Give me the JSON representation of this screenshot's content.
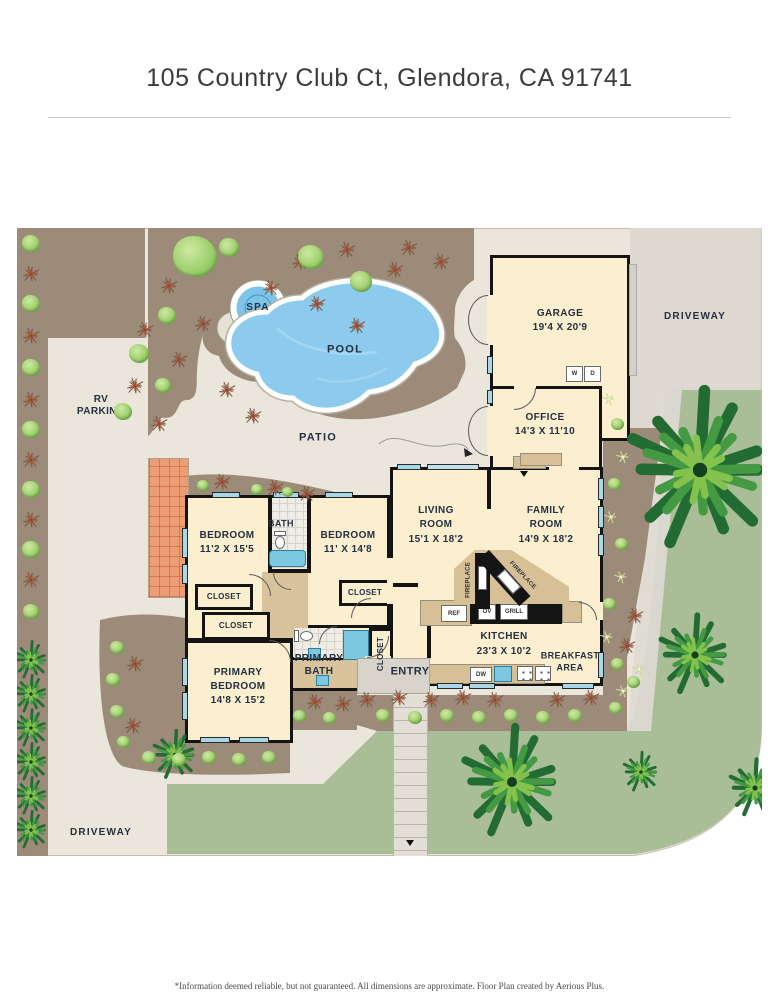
{
  "header": {
    "title": "105 Country Club Ct, Glendora, CA 91741"
  },
  "footer": {
    "disclaimer": "*Information deemed reliable, but not guaranteed. All dimensions are approximate. Floor Plan created by Aerious Plus."
  },
  "rooms": {
    "garage": {
      "name": "GARAGE",
      "dims": "19'4 X 20'9"
    },
    "office": {
      "name": "OFFICE",
      "dims": "14'3 X 11'10"
    },
    "living": {
      "l1": "LIVING",
      "l2": "ROOM",
      "dims": "15'1 X 18'2"
    },
    "family": {
      "l1": "FAMILY",
      "l2": "ROOM",
      "dims": "14'9 X 18'2"
    },
    "kitchen": {
      "name": "KITCHEN",
      "dims": "23'3 X 10'2"
    },
    "breakfast": {
      "l1": "BREAKFAST",
      "l2": "AREA"
    },
    "bedroom1": {
      "name": "BEDROOM",
      "dims": "11'2 X 15'5"
    },
    "bedroom2": {
      "name": "BEDROOM",
      "dims": "11' X 14'8"
    },
    "primary_bedroom": {
      "l1": "PRIMARY",
      "l2": "BEDROOM",
      "dims": "14'8 X 15'2"
    },
    "primary_bath": {
      "l1": "PRIMARY",
      "l2": "BATH"
    },
    "bath": {
      "name": "BATH"
    },
    "entry": {
      "name": "ENTRY"
    },
    "closet": "CLOSET"
  },
  "outdoor": {
    "pool": "POOL",
    "spa": "SPA",
    "patio": "PATIO",
    "rv_l1": "RV",
    "rv_l2": "PARKING",
    "driveway_right": "DRIVEWAY",
    "driveway_bottom": "DRIVEWAY"
  },
  "fixtures": {
    "washer": "W",
    "dryer": "D",
    "fridge": "REF",
    "oven": "OV",
    "grill": "GRILL",
    "dishwasher": "DW",
    "fireplace": "FIREPLACE"
  },
  "colors": {
    "site": "#eae6db",
    "planting_bed": "#9c8b78",
    "lawn": "#a9bd97",
    "driveway": "#ddd8d0",
    "room_fill": "#fbefcf",
    "wall": "#141414",
    "pool_water": "#8ccaee",
    "window": "#a8d8e7",
    "tile_patio": "#ec9d74",
    "counter": "#d8c096",
    "label_text": "#243040"
  },
  "plants": {
    "bushes": [
      [
        178,
        30,
        44
      ],
      [
        150,
        88,
        18
      ],
      [
        122,
        126,
        20
      ],
      [
        146,
        158,
        16
      ],
      [
        106,
        184,
        18
      ],
      [
        294,
        30,
        26
      ],
      [
        344,
        54,
        22
      ],
      [
        212,
        20,
        20
      ],
      [
        14,
        16,
        18
      ],
      [
        14,
        76,
        18
      ],
      [
        14,
        140,
        18
      ],
      [
        14,
        202,
        18
      ],
      [
        14,
        262,
        18
      ],
      [
        14,
        322,
        18
      ],
      [
        14,
        384,
        16
      ],
      [
        600,
        196,
        13
      ],
      [
        597,
        256,
        13
      ],
      [
        604,
        316,
        13
      ],
      [
        592,
        376,
        13
      ],
      [
        600,
        436,
        13
      ],
      [
        366,
        488,
        14
      ],
      [
        398,
        490,
        14
      ],
      [
        430,
        488,
        14
      ],
      [
        462,
        490,
        14
      ],
      [
        494,
        488,
        14
      ],
      [
        526,
        490,
        14
      ],
      [
        558,
        488,
        14
      ],
      [
        598,
        480,
        13
      ],
      [
        616,
        454,
        13
      ],
      [
        100,
        420,
        14
      ],
      [
        96,
        452,
        14
      ],
      [
        100,
        484,
        14
      ],
      [
        106,
        514,
        13
      ],
      [
        132,
        530,
        14
      ],
      [
        162,
        532,
        14
      ],
      [
        192,
        530,
        14
      ],
      [
        222,
        532,
        14
      ],
      [
        252,
        530,
        14
      ],
      [
        282,
        488,
        13
      ],
      [
        312,
        490,
        13
      ],
      [
        186,
        258,
        12
      ],
      [
        240,
        262,
        12
      ],
      [
        270,
        264,
        11
      ]
    ],
    "spiky": [
      [
        152,
        58
      ],
      [
        186,
        96
      ],
      [
        128,
        102
      ],
      [
        162,
        132
      ],
      [
        118,
        158
      ],
      [
        142,
        196
      ],
      [
        254,
        60
      ],
      [
        283,
        34
      ],
      [
        330,
        22
      ],
      [
        378,
        42
      ],
      [
        300,
        76
      ],
      [
        340,
        98
      ],
      [
        210,
        162
      ],
      [
        236,
        188
      ],
      [
        392,
        20
      ],
      [
        424,
        34
      ],
      [
        14,
        46
      ],
      [
        14,
        108
      ],
      [
        14,
        172
      ],
      [
        14,
        232
      ],
      [
        14,
        292
      ],
      [
        14,
        352
      ],
      [
        350,
        472
      ],
      [
        382,
        470
      ],
      [
        414,
        472
      ],
      [
        446,
        470
      ],
      [
        478,
        472
      ],
      [
        540,
        472
      ],
      [
        574,
        470
      ],
      [
        610,
        418
      ],
      [
        618,
        388
      ],
      [
        118,
        436
      ],
      [
        116,
        498
      ],
      [
        298,
        474
      ],
      [
        326,
        476
      ],
      [
        205,
        254
      ],
      [
        258,
        260
      ],
      [
        290,
        266
      ]
    ],
    "flowers": [
      [
        592,
        170
      ],
      [
        606,
        228
      ],
      [
        594,
        288
      ],
      [
        604,
        348
      ],
      [
        590,
        408
      ],
      [
        606,
        462
      ],
      [
        622,
        440
      ]
    ],
    "palms": [
      [
        683,
        242,
        72
      ],
      [
        678,
        427,
        36
      ],
      [
        495,
        554,
        50
      ],
      [
        738,
        560,
        26
      ],
      [
        624,
        544,
        18
      ],
      [
        158,
        527,
        22
      ],
      [
        14,
        432,
        17
      ],
      [
        14,
        466,
        17
      ],
      [
        14,
        500,
        17
      ],
      [
        14,
        534,
        17
      ],
      [
        14,
        568,
        17
      ],
      [
        14,
        602,
        17
      ]
    ]
  }
}
